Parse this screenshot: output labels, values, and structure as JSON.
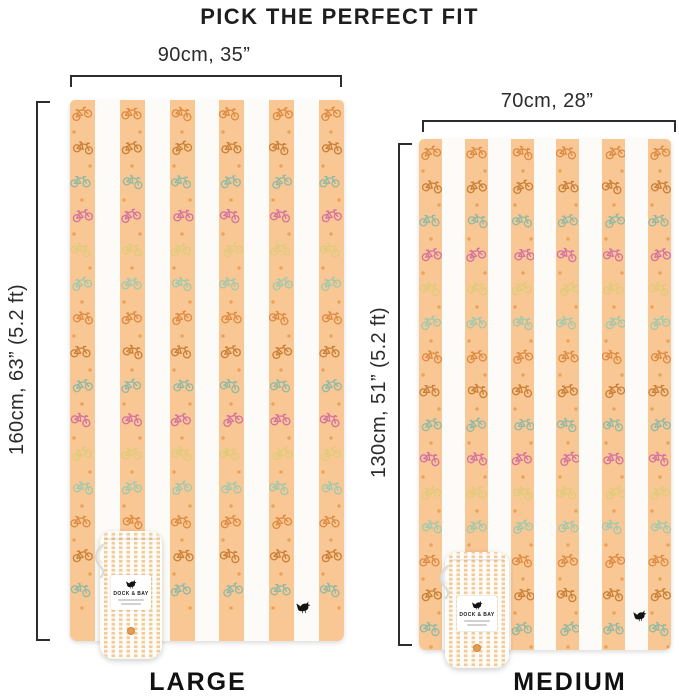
{
  "title": "PICK THE PERFECT FIT",
  "large": {
    "size_name": "LARGE",
    "width_label": "90cm, 35”",
    "height_label": "160cm, 63” (5.2 ft)"
  },
  "medium": {
    "size_name": "MEDIUM",
    "width_label": "70cm, 28”",
    "height_label": "130cm, 51” (5.2 ft)"
  },
  "pouch": {
    "brand": "DOCK & BAY"
  },
  "pattern": {
    "motif": "bicycle",
    "stripe_style": "cabana-vertical-stripes"
  },
  "colors": {
    "towel_orange": "#f8c794",
    "towel_white": "#fcfbf8",
    "text": "#1e1e1e",
    "bracket": "#2d2d2d",
    "accent_dot": "#e89a4f",
    "logo_black": "#131313",
    "bike_palette": [
      "#dd8a42",
      "#9fc9ae",
      "#e0cb7a",
      "#d4719f",
      "#8fb9a5",
      "#c97f36"
    ]
  }
}
